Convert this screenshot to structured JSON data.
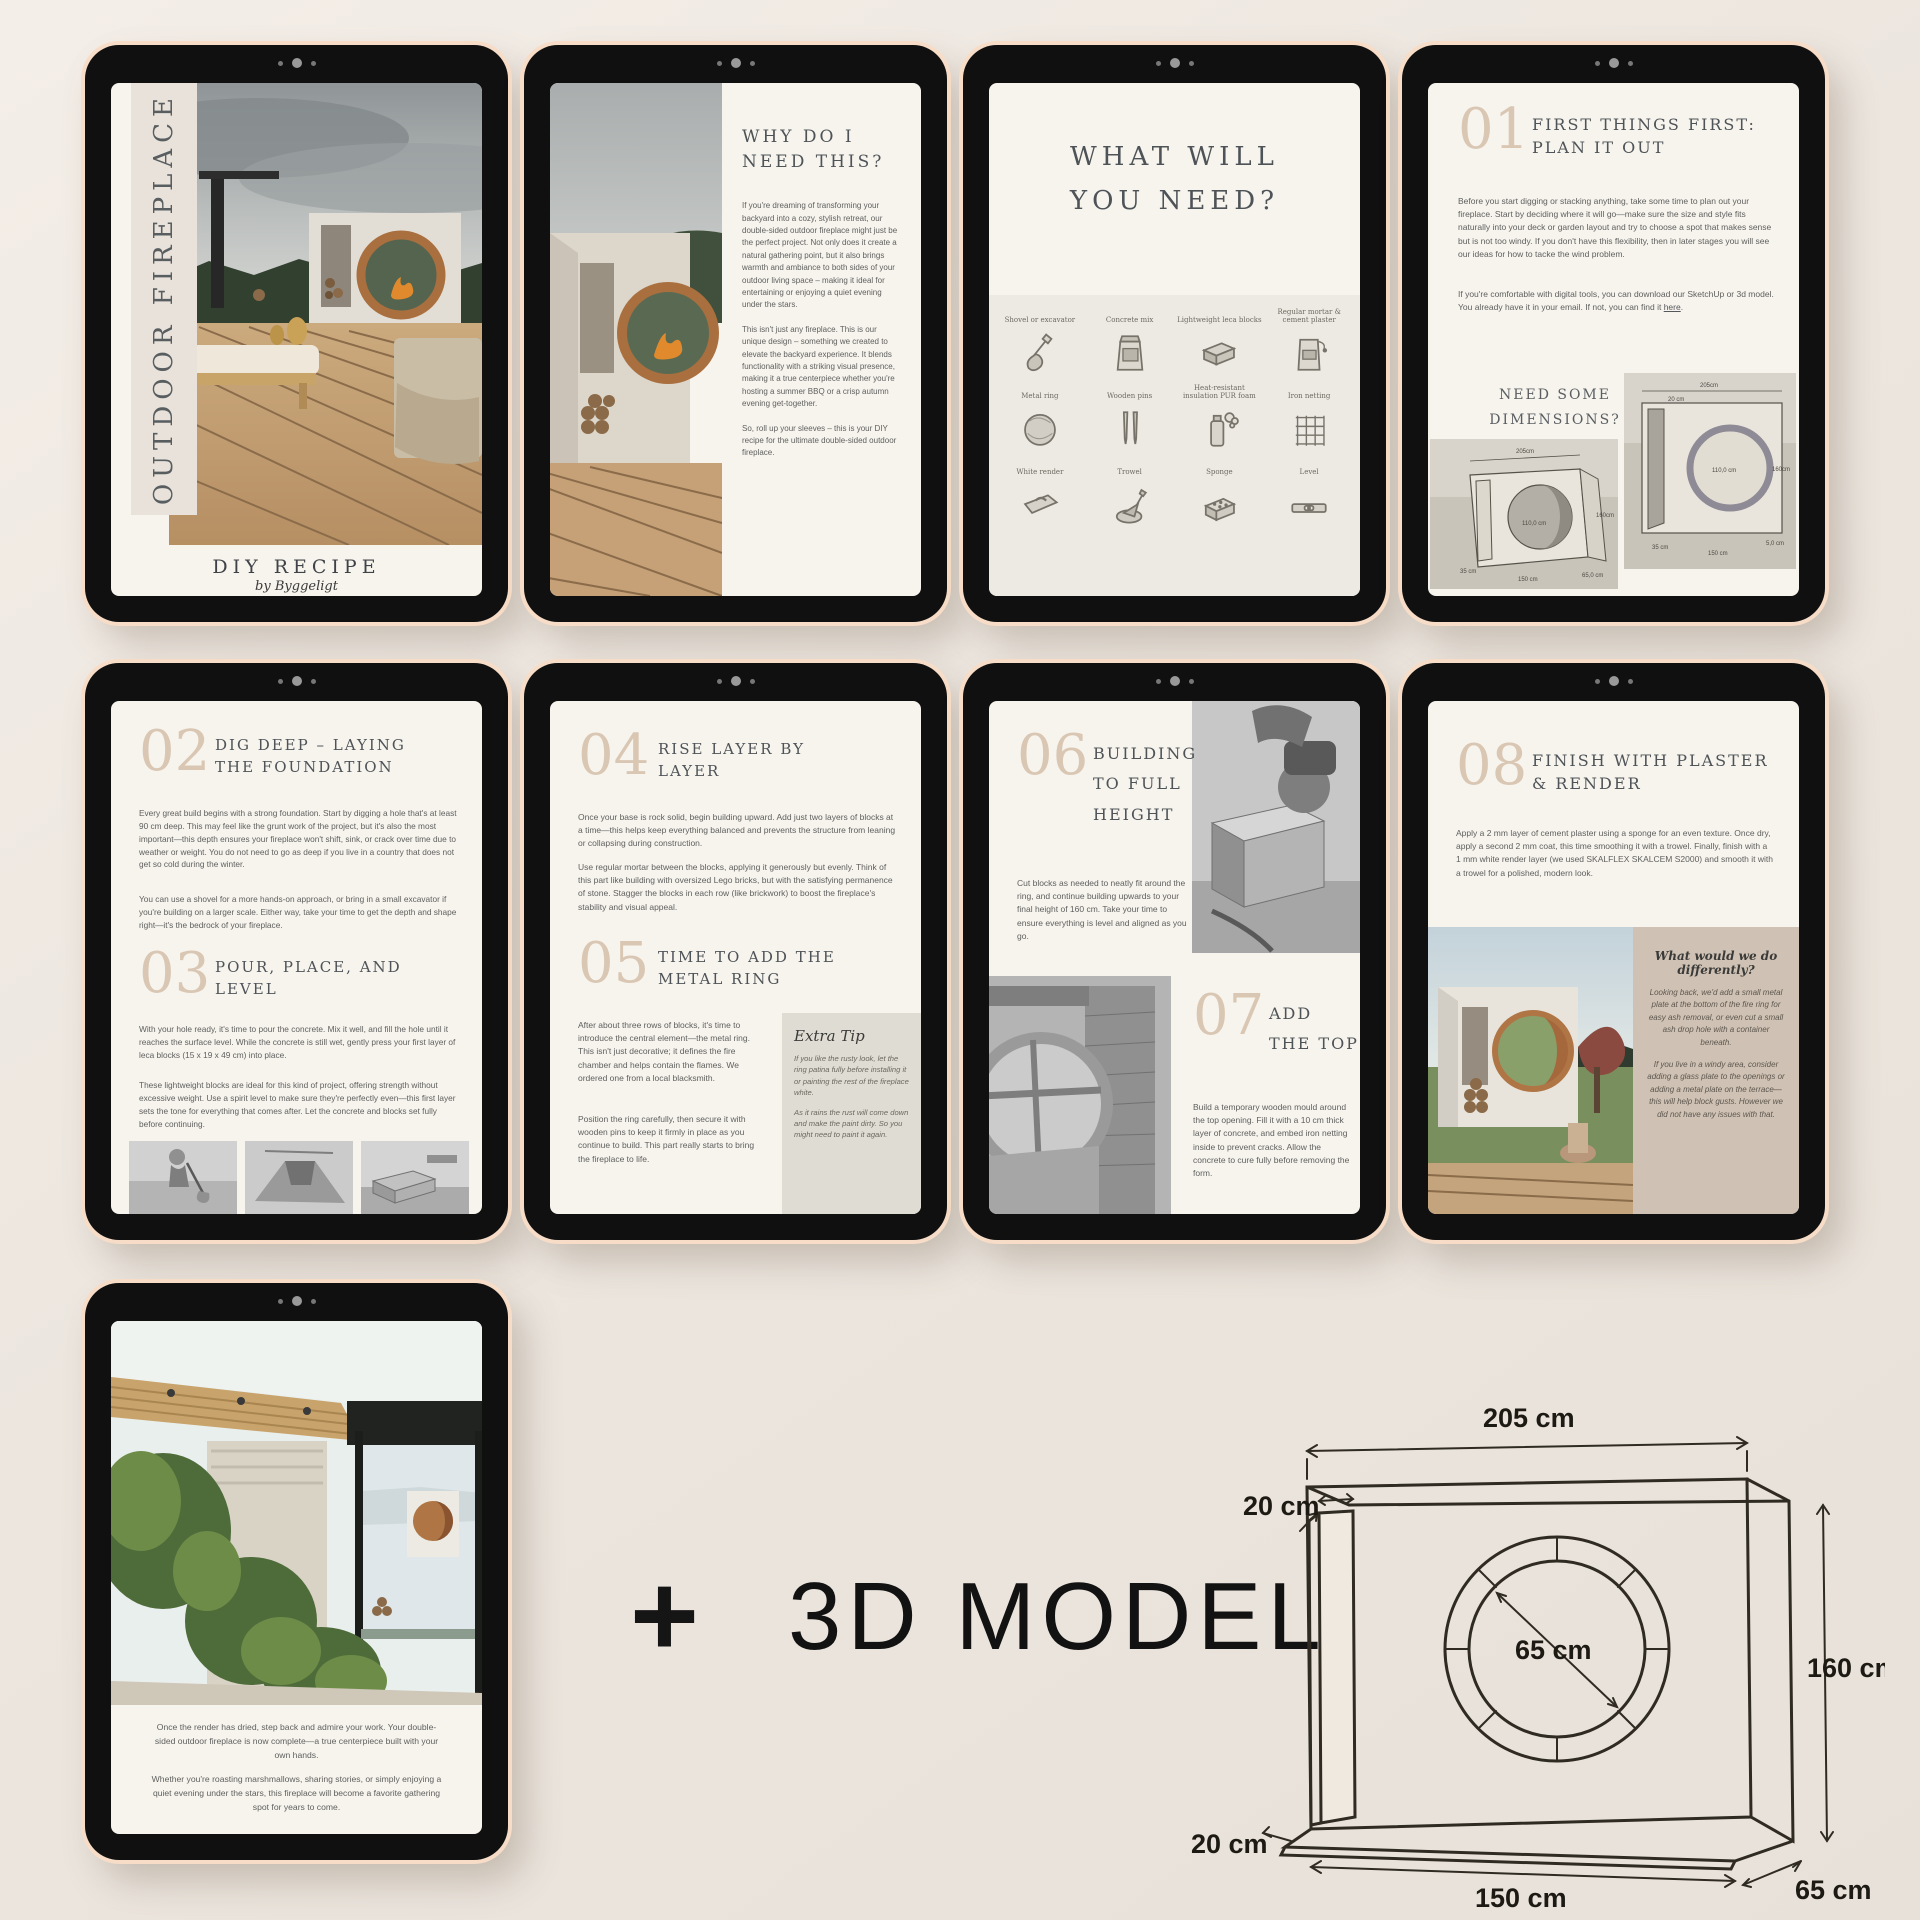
{
  "cover": {
    "vertical_title": "OUTDOOR FIREPLACE",
    "subtitle": "DIY RECIPE",
    "byline": "by Byggeligt"
  },
  "why": {
    "title": "WHY DO I NEED THIS?",
    "p1": "If you're dreaming of transforming your backyard into a cozy, stylish retreat, our double-sided outdoor fireplace might just be the perfect project. Not only does it create a natural gathering point, but it also brings warmth and ambiance to both sides of your outdoor living space – making it ideal for entertaining or enjoying a quiet evening under the stars.",
    "p2": "This isn't just any fireplace. This is our unique design – something we created to elevate the backyard experience. It blends functionality with a striking visual presence, making it a true centerpiece whether you're hosting a summer BBQ or a crisp autumn evening get-together.",
    "p3": "So, roll up your sleeves – this is your DIY recipe for the ultimate double-sided outdoor fireplace."
  },
  "need": {
    "title": "WHAT WILL YOU NEED?",
    "items": [
      "Shovel or excavator",
      "Concrete mix",
      "Lightweight leca blocks",
      "Regular mortar & cement plaster",
      "Metal ring",
      "Wooden pins",
      "Heat-resistant insulation PUR foam",
      "Iron netting",
      "White render",
      "Trowel",
      "Sponge",
      "Level"
    ]
  },
  "step01": {
    "number": "01",
    "title": "FIRST THINGS FIRST: PLAN IT OUT",
    "p1": "Before you start digging or stacking anything, take some time to plan out your fireplace. Start by deciding where it will go—make sure the size and style fits naturally into your deck or garden layout and try to choose a spot that makes sense but is not too windy. If you don't have this flexibility, then in later stages you will see our ideas for how to tacke the wind problem.",
    "p2_before_link": "If you're comfortable with digital tools, you can download our SketchUp or 3d model.  You already have it in your email. If not, you can find it ",
    "link_label": "here",
    "p2_after_link": ".",
    "dims_heading": "NEED SOME DIMENSIONS?",
    "diagram": {
      "w": "205cm",
      "h": "160cm",
      "base": "150 cm",
      "depth": "65,0 cm",
      "inner": "110,0 cm",
      "slab": "35 cm",
      "wall": "20 cm",
      "plate": "5,0 cm"
    }
  },
  "step02": {
    "number": "02",
    "title": "DIG DEEP – LAYING THE FOUNDATION",
    "p1": "Every great build begins with a strong foundation. Start by digging a hole that's at least 90 cm deep. This may feel like the grunt work of the project, but it's also the most important—this depth ensures your fireplace won't shift, sink, or crack over time due to weather or weight. You do not need to go as deep if you live in a country that does not get so cold during the winter.",
    "p2": "You can use a shovel for a more hands-on approach, or bring in a small excavator if you're building on a larger scale. Either way, take your time to get the depth and shape right—it's the bedrock of your fireplace."
  },
  "step03": {
    "number": "03",
    "title": "POUR, PLACE, AND LEVEL",
    "p1": "With your hole ready, it's time to pour the concrete. Mix it well, and fill the hole until it reaches the surface level. While the concrete is still wet, gently press your first layer of leca blocks (15 x 19 x 49 cm) into place.",
    "p2": "These lightweight blocks are ideal for this kind of project, offering strength without excessive weight. Use a spirit level to make sure they're perfectly even—this first layer sets the tone for everything that comes after. Let the concrete and blocks set fully before continuing."
  },
  "step04": {
    "number": "04",
    "title": "RISE LAYER BY LAYER",
    "p1": "Once your base is rock solid, begin building upward. Add just two layers of blocks at a time—this helps keep everything balanced and prevents the structure from leaning or collapsing during construction.",
    "p2": "Use regular mortar between the blocks, applying it generously but evenly. Think of this part like building with oversized Lego bricks, but with the satisfying permanence of stone. Stagger the blocks in each row (like brickwork) to boost the fireplace's stability and visual appeal."
  },
  "step05": {
    "number": "05",
    "title": "TIME TO ADD THE METAL RING",
    "p1": "After about three rows of blocks, it's time to introduce the central element—the metal ring. This isn't just decorative; it defines the fire chamber and helps contain the flames. We ordered one from a local blacksmith.",
    "p2": "Position the ring carefully, then secure it with wooden pins to keep it firmly in place as you continue to build. This part really starts to bring the fireplace to life.",
    "tip_title": "Extra Tip",
    "tip_p1": "If you like the rusty look, let the ring patina fully before installing it or painting the rest of the fireplace white.",
    "tip_p2": "As it rains the rust will come down and make the paint dirty. So you might need to paint it again."
  },
  "step06": {
    "number": "06",
    "title": "BUILDING TO FULL HEIGHT",
    "p1": "Cut blocks as needed to neatly fit around the ring, and continue building upwards to your final height of 160 cm. Take your time to ensure everything is level and aligned as you go."
  },
  "step07": {
    "number": "07",
    "title": "ADD THE TOP",
    "p1": "Build a temporary wooden mould around the top opening. Fill it with a 10 cm thick layer of concrete, and embed iron netting inside to prevent cracks. Allow the concrete to cure fully before removing the form."
  },
  "step08": {
    "number": "08",
    "title": "FINISH WITH PLASTER & RENDER",
    "p1": "Apply a 2 mm layer of cement plaster using a sponge for an even texture. Once dry, apply a second 2 mm coat, this time smoothing it with a trowel. Finally, finish with a 1 mm white render layer (we used SKALFLEX SKALCEM S2000) and smooth it with a trowel for a polished, modern look.",
    "box_title": "What would we do differently?",
    "box_p1": "Looking back, we'd add a small metal plate at the bottom of the fire ring for easy ash removal, or even cut a small ash drop hole with a container beneath.",
    "box_p2": "If you live in a windy area, consider adding a glass plate to the openings or adding a metal plate on the terrace—this will help block gusts. However we did not have any issues with that."
  },
  "closing": {
    "p1": "Once the render has dried, step back and admire your work. Your double-sided outdoor fireplace is now complete—a true centerpiece built with your own hands.",
    "p2": "Whether you're roasting marshmallows, sharing stories, or simply enjoying a quiet evening under the stars, this fireplace will become a favorite gathering spot for years to come."
  },
  "model": {
    "plus": "+",
    "label": "3D MODEL"
  },
  "diagram3d": {
    "top": "205 cm",
    "wall": "20 cm",
    "circle": "65 cm",
    "height": "160 cm",
    "base_left": "20 cm",
    "width": "150 cm",
    "depth": "65 cm"
  },
  "colors": {
    "accent_taupe": "#d9c7b3",
    "heading_gray": "#4e5357",
    "bezel_black": "#101010",
    "rim_cream": "#f7ddc7",
    "page_cream": "#f7f4ee",
    "rust_ring": "#a96f3f",
    "tip_box": "#dfdcd3",
    "differently_box": "#cfc2b4"
  }
}
